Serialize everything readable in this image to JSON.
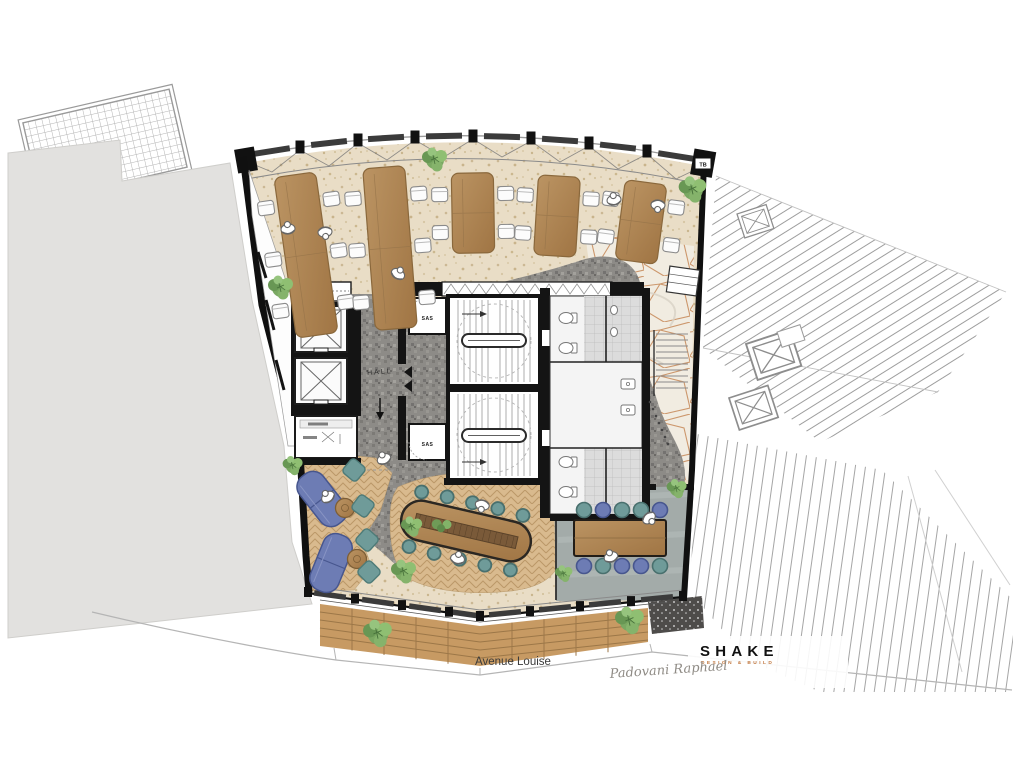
{
  "plan": {
    "street_label": "Avenue Louise",
    "hall_label": "HALL",
    "sas_top_label": "SAS",
    "sas_bottom_label": "SAS",
    "tb_label": "TB"
  },
  "branding": {
    "logo": "SHAKE",
    "tagline": "DESIGN & BUILD",
    "signature": "Padovani Raphael"
  },
  "colors": {
    "accent_copper": "#c0763d",
    "desk_wood": "#b8905e",
    "lounge_wood": "#d9ba8e",
    "deck_wood": "#c79a63",
    "sofa_blue": "#6d7cb4",
    "pouf_teal": "#6f9b99",
    "carpet_gray": "#8d8b87",
    "terrazzo_beige": "#e9ddc6",
    "meeting_floor": "#a3aba9",
    "neighbor_gray": "#e2e1df",
    "plant_green": "#7aa862",
    "wall_black": "#141414"
  }
}
